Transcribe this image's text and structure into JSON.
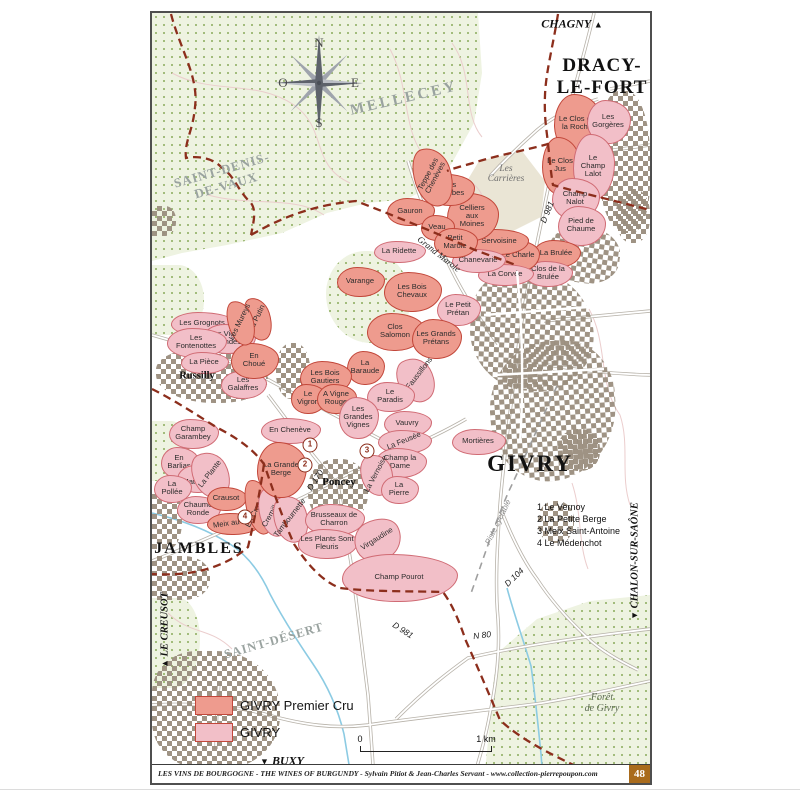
{
  "edge": {
    "top_label": "CHAGNY",
    "top_arrow": "▲",
    "bottom_label": "BUXY",
    "bottom_arrow": "▼",
    "left_label": "LE CREUSOT",
    "left_arrow": "▲",
    "right_label": "CHALON-SUR-SAÔNE",
    "right_arrow": "▼"
  },
  "compass": {
    "n": "N",
    "s": "S",
    "e": "E",
    "o": "O"
  },
  "towns": [
    {
      "t": "DRACY-LE-FORT",
      "lines": [
        "DRACY-",
        "LE-FORT"
      ],
      "x": 450,
      "y": 64,
      "fs": 19,
      "ls": 1
    },
    {
      "t": "GIVRY",
      "x": 378,
      "y": 451,
      "fs": 23,
      "ls": 2
    },
    {
      "t": "JAMBLES",
      "x": 47,
      "y": 536,
      "fs": 16,
      "ls": 2
    },
    {
      "t": "Russilly",
      "x": 45,
      "y": 363,
      "fs": 10.5,
      "ls": 0
    },
    {
      "t": "Poncey",
      "x": 187,
      "y": 469,
      "fs": 11,
      "ls": 0
    }
  ],
  "regions": [
    {
      "t": "MELLECEY",
      "x": 252,
      "y": 86,
      "r": -13,
      "fs": 15,
      "ls": 3,
      "cls": ""
    },
    {
      "t": "SAINT-DENIS-DE-VAUX",
      "lines": [
        "SAINT-DENIS-",
        "DE-VAUX"
      ],
      "x": 72,
      "y": 165,
      "r": -16,
      "fs": 13,
      "ls": 1,
      "cls": ""
    },
    {
      "t": "SAINT-DÉSERT",
      "x": 122,
      "y": 628,
      "r": -16,
      "fs": 12.5,
      "ls": 1,
      "cls": ""
    },
    {
      "t": "Les Carrières",
      "lines": [
        "Les",
        "Carrières"
      ],
      "x": 354,
      "y": 161,
      "r": 0,
      "fs": 9.5,
      "ls": 0,
      "cls": "it"
    },
    {
      "t": "Forêt de Givry",
      "lines": [
        "Forêt",
        "de Givry"
      ],
      "x": 450,
      "y": 690,
      "r": 0,
      "fs": 10,
      "ls": 0,
      "cls": "it2"
    }
  ],
  "road_labels": [
    {
      "t": "D 981",
      "x": 395,
      "y": 199,
      "r": -68,
      "cls": ""
    },
    {
      "t": "D 981",
      "x": 251,
      "y": 617,
      "r": 33,
      "cls": ""
    },
    {
      "t": "D 170",
      "x": 163,
      "y": 467,
      "r": -57,
      "cls": ""
    },
    {
      "t": "D 104",
      "x": 362,
      "y": 564,
      "r": -44,
      "cls": ""
    },
    {
      "t": "N 80",
      "x": 330,
      "y": 622,
      "r": -7,
      "cls": ""
    },
    {
      "t": "Grand Marole",
      "x": 287,
      "y": 241,
      "r": 38,
      "cls": "rdit"
    },
    {
      "t": "Piste cyclable",
      "x": 346,
      "y": 509,
      "r": -64,
      "cls": "rdgy"
    }
  ],
  "parcels": [
    {
      "t": "Le Clos de la Roche",
      "x": 425,
      "y": 110,
      "w": 46,
      "h": 58,
      "c": "pc",
      "lw": 40
    },
    {
      "t": "Les Gorgères",
      "x": 456,
      "y": 108,
      "w": 42,
      "h": 42,
      "c": "vg",
      "lw": 38
    },
    {
      "t": "Le Clos Jus",
      "x": 408,
      "y": 152,
      "w": 36,
      "h": 56,
      "c": "pc",
      "lw": 26
    },
    {
      "t": "Le Champ Lalot",
      "x": 441,
      "y": 153,
      "w": 40,
      "h": 64,
      "c": "vg",
      "lw": 34
    },
    {
      "t": "Champ Nalot",
      "x": 423,
      "y": 185,
      "w": 46,
      "h": 40,
      "c": "vg",
      "lw": 36
    },
    {
      "t": "Pied de Chaume",
      "x": 429,
      "y": 212,
      "w": 46,
      "h": 38,
      "c": "vg",
      "lw": 40
    },
    {
      "t": "La Brulée",
      "x": 404,
      "y": 240,
      "w": 46,
      "h": 26,
      "c": "pc",
      "lw": 48,
      "nw": 1
    },
    {
      "t": "Clos de la Brulée",
      "x": 396,
      "y": 260,
      "w": 46,
      "h": 24,
      "c": "vg",
      "lw": 44
    },
    {
      "t": "Le Charle",
      "x": 366,
      "y": 242,
      "w": 40,
      "h": 30,
      "c": "pc",
      "lw": 34
    },
    {
      "t": "La Corvée",
      "x": 353,
      "y": 261,
      "w": 54,
      "h": 20,
      "c": "vg",
      "lw": 52,
      "nw": 1
    },
    {
      "t": "Servoisine",
      "x": 347,
      "y": 228,
      "w": 56,
      "h": 24,
      "c": "pc",
      "lw": 52,
      "nw": 1
    },
    {
      "t": "Chanevarie",
      "x": 326,
      "y": 247,
      "w": 52,
      "h": 22,
      "c": "vg",
      "lw": 52,
      "nw": 1
    },
    {
      "t": "Celliers aux Moines",
      "x": 320,
      "y": 203,
      "w": 50,
      "h": 46,
      "c": "pc",
      "lw": 34
    },
    {
      "t": "Les Combes",
      "x": 298,
      "y": 176,
      "w": 46,
      "h": 30,
      "c": "pc",
      "lw": 38
    },
    {
      "t": "Teppe des Chenèves",
      "x": 280,
      "y": 163,
      "w": 36,
      "h": 58,
      "c": "pc",
      "r": -18,
      "tr": -62,
      "lw": 58
    },
    {
      "t": "Gauron",
      "x": 258,
      "y": 198,
      "w": 46,
      "h": 26,
      "c": "pc",
      "lw": 40,
      "nw": 1
    },
    {
      "t": "Veau",
      "x": 285,
      "y": 214,
      "w": 32,
      "h": 24,
      "c": "pc",
      "lw": 30,
      "nw": 1
    },
    {
      "t": "Petit Marole",
      "x": 303,
      "y": 229,
      "w": 42,
      "h": 28,
      "c": "pc",
      "lw": 32
    },
    {
      "t": "La Ridette",
      "x": 247,
      "y": 238,
      "w": 50,
      "h": 20,
      "c": "vg",
      "lw": 48,
      "nw": 1
    },
    {
      "t": "Varange",
      "x": 208,
      "y": 268,
      "w": 46,
      "h": 28,
      "c": "pc",
      "lw": 44,
      "nw": 1
    },
    {
      "t": "Les Bois Chevaux",
      "x": 260,
      "y": 278,
      "w": 56,
      "h": 38,
      "c": "pc",
      "lw": 40
    },
    {
      "t": "Le Petit Prétan",
      "x": 306,
      "y": 296,
      "w": 42,
      "h": 30,
      "c": "vg",
      "lw": 36
    },
    {
      "t": "Clos Salomon",
      "x": 243,
      "y": 318,
      "w": 56,
      "h": 36,
      "c": "pc",
      "lw": 42
    },
    {
      "t": "Les Grands Prétans",
      "x": 284,
      "y": 325,
      "w": 48,
      "h": 38,
      "c": "pc",
      "lw": 42
    },
    {
      "t": "Les Faussillons",
      "x": 263,
      "y": 366,
      "w": 34,
      "h": 44,
      "c": "vg",
      "r": -30,
      "tr": -52,
      "lw": 64
    },
    {
      "t": "Le Paradis",
      "x": 238,
      "y": 383,
      "w": 46,
      "h": 28,
      "c": "vg",
      "lw": 36
    },
    {
      "t": "Vauvry",
      "x": 255,
      "y": 410,
      "w": 46,
      "h": 24,
      "c": "vg",
      "lw": 40,
      "nw": 1
    },
    {
      "t": "La Feusée",
      "x": 252,
      "y": 428,
      "w": 52,
      "h": 22,
      "c": "vg",
      "tr": -22,
      "lw": 52
    },
    {
      "t": "Champ la Dame",
      "x": 248,
      "y": 449,
      "w": 50,
      "h": 28,
      "c": "vg",
      "lw": 40
    },
    {
      "t": "La Vernoise",
      "x": 224,
      "y": 461,
      "w": 30,
      "h": 40,
      "c": "vg",
      "r": -20,
      "tr": -62,
      "lw": 56
    },
    {
      "t": "La Pierre",
      "x": 247,
      "y": 476,
      "w": 36,
      "h": 26,
      "c": "vg",
      "lw": 30
    },
    {
      "t": "Mortières",
      "x": 326,
      "y": 428,
      "w": 52,
      "h": 24,
      "c": "vg",
      "lw": 50,
      "nw": 1
    },
    {
      "t": "La Baraude",
      "x": 213,
      "y": 354,
      "w": 36,
      "h": 32,
      "c": "pc",
      "lw": 34
    },
    {
      "t": "Les Bois Gautiers",
      "x": 173,
      "y": 364,
      "w": 50,
      "h": 32,
      "c": "pc",
      "lw": 42
    },
    {
      "t": "Le Vigron",
      "x": 156,
      "y": 385,
      "w": 34,
      "h": 28,
      "c": "pc",
      "lw": 30
    },
    {
      "t": "A Vigne Rouge",
      "x": 184,
      "y": 385,
      "w": 38,
      "h": 28,
      "c": "pc",
      "lw": 34
    },
    {
      "t": "Les Grandes Vignes",
      "x": 206,
      "y": 404,
      "w": 38,
      "h": 40,
      "c": "vg",
      "lw": 40
    },
    {
      "t": "En Chenève",
      "x": 138,
      "y": 417,
      "w": 58,
      "h": 24,
      "c": "vg",
      "lw": 56,
      "nw": 1
    },
    {
      "t": "Les Grognots",
      "x": 50,
      "y": 310,
      "w": 62,
      "h": 22,
      "c": "vg",
      "lw": 60,
      "nw": 1
    },
    {
      "t": "Les Vignes Rondes",
      "x": 76,
      "y": 325,
      "w": 52,
      "h": 28,
      "c": "vg",
      "lw": 46
    },
    {
      "t": "Les Fontenottes",
      "x": 44,
      "y": 329,
      "w": 58,
      "h": 28,
      "c": "vg",
      "lw": 50
    },
    {
      "t": "La Pièce",
      "x": 52,
      "y": 349,
      "w": 46,
      "h": 20,
      "c": "vg",
      "lw": 40,
      "nw": 1
    },
    {
      "t": "Les Galaffres",
      "x": 91,
      "y": 371,
      "w": 44,
      "h": 26,
      "c": "vg",
      "lw": 40
    },
    {
      "t": "En Choué",
      "x": 102,
      "y": 347,
      "w": 46,
      "h": 34,
      "c": "pc",
      "lw": 30
    },
    {
      "t": "La Putin",
      "x": 105,
      "y": 305,
      "w": 24,
      "h": 42,
      "c": "pc",
      "r": -18,
      "tr": -64,
      "lw": 44
    },
    {
      "t": "Les Mureys",
      "x": 88,
      "y": 309,
      "w": 24,
      "h": 44,
      "c": "pc",
      "r": -18,
      "tr": -64,
      "lw": 56
    },
    {
      "t": "Champ Garambey",
      "x": 41,
      "y": 420,
      "w": 48,
      "h": 28,
      "c": "vg",
      "lw": 44
    },
    {
      "t": "En Barlias",
      "x": 27,
      "y": 449,
      "w": 36,
      "h": 30,
      "c": "vg",
      "lw": 30
    },
    {
      "t": "La Matrosse",
      "x": 46,
      "y": 465,
      "w": 42,
      "h": 26,
      "c": "vg",
      "lw": 40
    },
    {
      "t": "La Pollée",
      "x": 20,
      "y": 475,
      "w": 36,
      "h": 26,
      "c": "vg",
      "lw": 28
    },
    {
      "t": "La Plante",
      "x": 58,
      "y": 461,
      "w": 34,
      "h": 46,
      "c": "vg",
      "r": -28,
      "tr": -52,
      "lw": 48
    },
    {
      "t": "Chaume Ronde",
      "x": 46,
      "y": 496,
      "w": 42,
      "h": 26,
      "c": "vg",
      "lw": 40
    },
    {
      "t": "Crausot",
      "x": 74,
      "y": 485,
      "w": 38,
      "h": 22,
      "c": "pc",
      "lw": 40,
      "nw": 1
    },
    {
      "t": "Meix au Roi",
      "x": 81,
      "y": 510,
      "w": 52,
      "h": 20,
      "c": "pc",
      "tr": -8,
      "lw": 54
    },
    {
      "t": "En Cras Long",
      "x": 106,
      "y": 493,
      "w": 24,
      "h": 54,
      "c": "pc",
      "r": -14,
      "tr": -64,
      "lw": 60
    },
    {
      "t": "Cremillons",
      "x": 121,
      "y": 498,
      "w": 28,
      "h": 48,
      "c": "vg",
      "r": -14,
      "tr": -60,
      "lw": 54
    },
    {
      "t": "Tambournette",
      "x": 138,
      "y": 505,
      "w": 32,
      "h": 46,
      "c": "vg",
      "r": -18,
      "tr": -52,
      "lw": 66
    },
    {
      "t": "La Grande Berge",
      "x": 129,
      "y": 456,
      "w": 48,
      "h": 54,
      "c": "pc",
      "lw": 40
    },
    {
      "t": "Brusseaux de Charron",
      "x": 182,
      "y": 506,
      "w": 58,
      "h": 30,
      "c": "vg",
      "lw": 52
    },
    {
      "t": "Les Plants Sont Fleuris",
      "x": 175,
      "y": 530,
      "w": 58,
      "h": 28,
      "c": "vg",
      "lw": 54
    },
    {
      "t": "Virgaudine",
      "x": 225,
      "y": 526,
      "w": 46,
      "h": 40,
      "c": "vg",
      "r": -28,
      "tr": -32,
      "lw": 56
    },
    {
      "t": "Champ Pourot",
      "x": 247,
      "y": 564,
      "w": 114,
      "h": 46,
      "c": "vg",
      "lw": 70,
      "nw": 1
    }
  ],
  "markers": [
    {
      "n": "1",
      "x": 158,
      "y": 432
    },
    {
      "n": "2",
      "x": 153,
      "y": 452
    },
    {
      "n": "3",
      "x": 215,
      "y": 438
    },
    {
      "n": "4",
      "x": 93,
      "y": 504
    }
  ],
  "refs": [
    {
      "n": "1",
      "label": "Le Vernoy"
    },
    {
      "n": "2",
      "label": "La Petite Berge"
    },
    {
      "n": "3",
      "label": "Meix Saint-Antoine"
    },
    {
      "n": "4",
      "label": "Le Médenchot"
    }
  ],
  "legend": {
    "items": [
      {
        "label": "GIVRY Premier Cru",
        "color": "#ee9b8e"
      },
      {
        "label": "GIVRY",
        "color": "#f2bfc8"
      }
    ]
  },
  "scale": {
    "zero": "0",
    "one": "1 km"
  },
  "footer": {
    "credit": "LES VINS DE BOURGOGNE - THE WINES OF BURGUNDY - Sylvain Pitiot & Jean-Charles Servant - www.collection-pierrepoupon.com",
    "page": "48"
  },
  "colors": {
    "premier_cru": "#ee9b8e",
    "givry_village": "#f2bfc8",
    "parcel_border": "#c2473a",
    "boundary_dash": "#8c2e1c",
    "forest_bg": "#eef3e1",
    "buildings": "#9a8e7e",
    "badge_bg": "#a96b1c"
  }
}
